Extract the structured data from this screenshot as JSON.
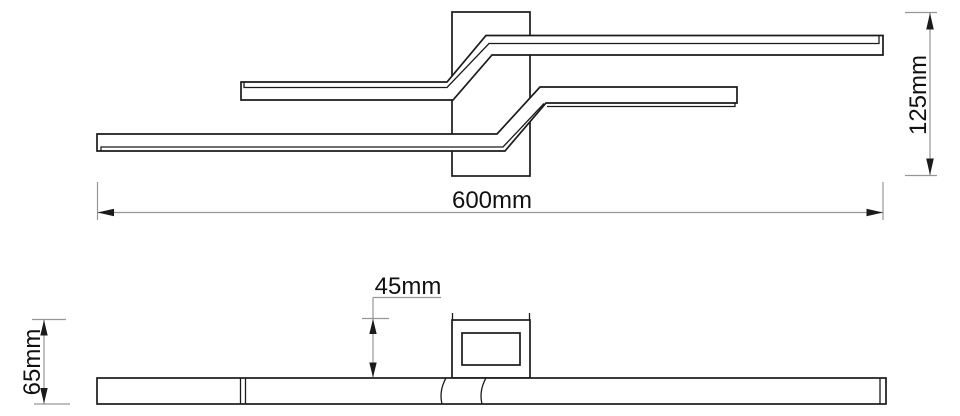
{
  "document": {
    "kind": "technical-dimension-drawing",
    "subject": "linear zigzag ceiling light fixture"
  },
  "colors": {
    "object_line": "#1b1b1b",
    "dim_line": "#969696",
    "text": "#111111",
    "background": "#ffffff"
  },
  "top_view": {
    "dim_width": {
      "label": "600mm",
      "value": 600,
      "unit": "mm"
    },
    "dim_depth": {
      "label": "125mm",
      "value": 125,
      "unit": "mm"
    }
  },
  "side_view": {
    "dim_canopy_height": {
      "label": "45mm",
      "value": 45,
      "unit": "mm"
    },
    "dim_total_height": {
      "label": "65mm",
      "value": 65,
      "unit": "mm"
    }
  }
}
